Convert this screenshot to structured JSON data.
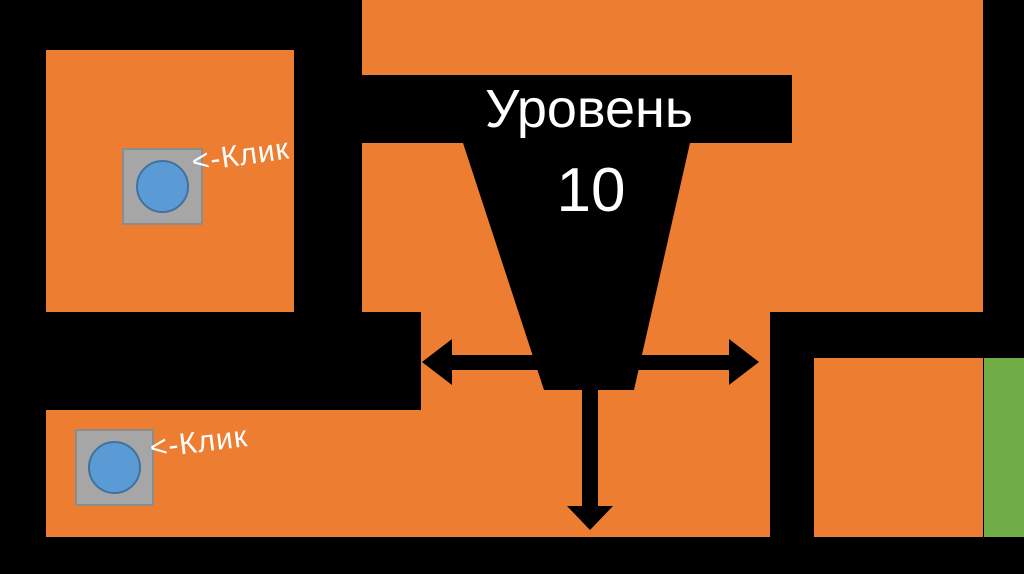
{
  "title": {
    "text": "Уровень",
    "level": "10"
  },
  "labels": {
    "click1": "<-Клик",
    "click2": "<-Клик"
  },
  "icons": {
    "button1": "blue-circle-click-button",
    "button2": "blue-circle-click-button",
    "horizontal_arrow": "double-headed-horizontal-arrow",
    "vertical_arrow": "down-arrow",
    "goal": "green-goal-strip"
  },
  "colors": {
    "wall_orange": "#ED7D31",
    "goal_green": "#70AD47",
    "button_blue": "#5B9BD5",
    "button_blue_border": "#41719C",
    "button_gray": "#A6A6A6",
    "button_gray_border": "#8C8C8C",
    "bg_black": "#000000",
    "text_white": "#FFFFFF"
  }
}
